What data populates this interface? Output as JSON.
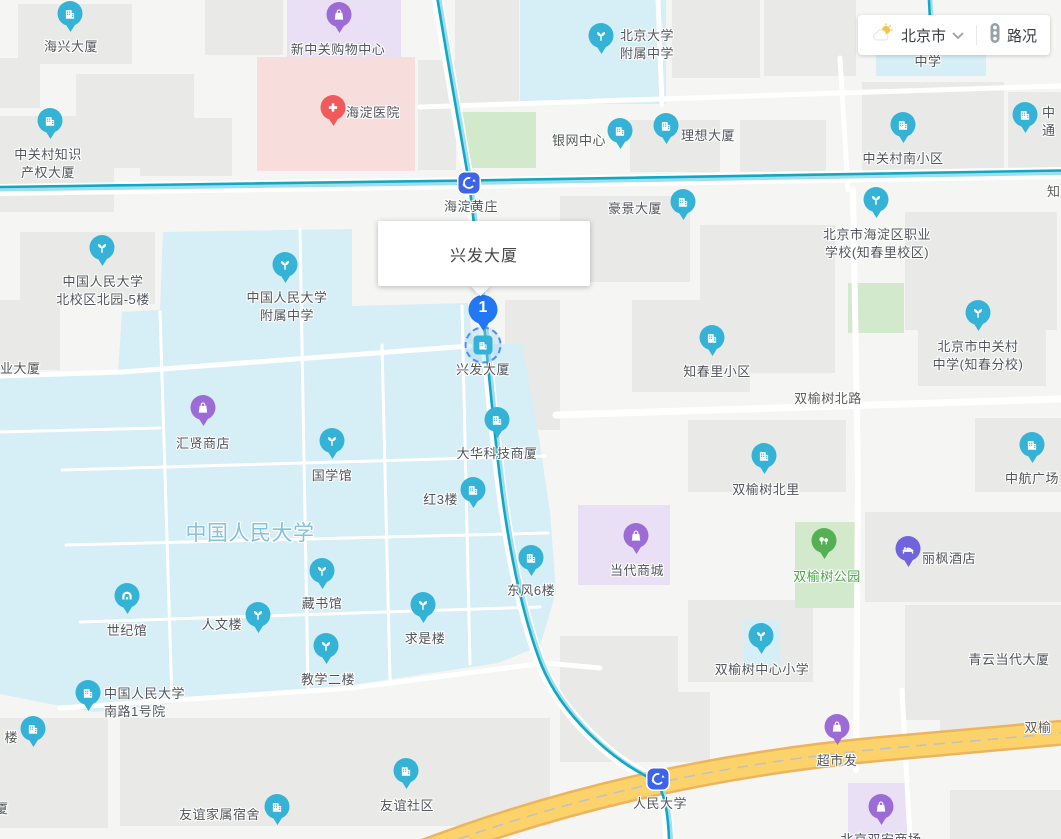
{
  "control": {
    "city": "北京市",
    "traffic_label": "路况"
  },
  "infowindow": {
    "title": "兴发大厦"
  },
  "selected_place": {
    "number": "1",
    "name": "兴发大厦"
  },
  "colors": {
    "pin_blue": "#35b3d7",
    "pin_purple": "#9c6bd6",
    "pin_violet": "#6f63de",
    "pin_green": "#55b054",
    "pin_red": "#ef5a5a",
    "selected_pin": "#2277f2",
    "station_blue": "#3d63ea",
    "subway_line": "#14a7c2",
    "highway_yellow": "#fbd36a",
    "campus_fill": "#d6eef5",
    "park_fill": "#d3e9cc",
    "hospital_fill": "#f8dddd",
    "mall_fill": "#e9e0f6"
  },
  "stations": [
    {
      "name": "海淀黄庄",
      "x": 469,
      "y": 183,
      "lx": 471,
      "ly": 198
    },
    {
      "name": "人民大学",
      "x": 658,
      "y": 779,
      "lx": 660,
      "ly": 795
    }
  ],
  "pois": [
    {
      "label": [
        "海兴大厦"
      ],
      "icon": "building",
      "color": "blue",
      "x": 70,
      "y": 34,
      "lx": 71,
      "ly": 38,
      "align": "center"
    },
    {
      "label": [
        "新中关购物中心"
      ],
      "icon": "bag",
      "color": "purple",
      "x": 339,
      "y": 35,
      "lx": 338,
      "ly": 41,
      "align": "center"
    },
    {
      "label": [
        "海淀医院"
      ],
      "icon": "cross",
      "color": "red",
      "x": 333,
      "y": 128,
      "lx": 346,
      "ly": 104,
      "align": "left"
    },
    {
      "label": [
        "中关村知识",
        "产权大厦"
      ],
      "icon": "building",
      "color": "blue",
      "x": 50,
      "y": 141,
      "lx": 48,
      "ly": 146,
      "align": "center"
    },
    {
      "label": [
        "北京大学",
        "附属中学"
      ],
      "icon": "sprout",
      "color": "blue",
      "x": 601,
      "y": 56,
      "lx": 620,
      "ly": 27,
      "align": "left"
    },
    {
      "label": [
        "银网中心"
      ],
      "icon": "building",
      "color": "blue",
      "x": 620,
      "y": 151,
      "lx": 606,
      "ly": 132,
      "align": "right"
    },
    {
      "label": [
        "理想大厦"
      ],
      "icon": "building",
      "color": "blue",
      "x": 666,
      "y": 146,
      "lx": 681,
      "ly": 127,
      "align": "left"
    },
    {
      "label": [
        "中关村南小区"
      ],
      "icon": "building",
      "color": "blue",
      "x": 903,
      "y": 145,
      "lx": 903,
      "ly": 150,
      "align": "center"
    },
    {
      "label": [
        "中",
        "通"
      ],
      "icon": "building",
      "color": "blue",
      "x": 1025,
      "y": 135,
      "lx": 1042,
      "ly": 104,
      "align": "left"
    },
    {
      "label": [
        "豪景大厦"
      ],
      "icon": "building",
      "color": "blue",
      "x": 683,
      "y": 222,
      "lx": 662,
      "ly": 200,
      "align": "right"
    },
    {
      "label": [
        "北京市海淀区职业",
        "学校(知春里校区)"
      ],
      "icon": "sprout",
      "color": "blue",
      "x": 876,
      "y": 220,
      "lx": 877,
      "ly": 226,
      "align": "center"
    },
    {
      "label": [
        "中国人民大学",
        "北校区北园-5楼"
      ],
      "icon": "sprout",
      "color": "blue",
      "x": 102,
      "y": 268,
      "lx": 103,
      "ly": 273,
      "align": "center"
    },
    {
      "label": [
        "中国人民大学",
        "附属中学"
      ],
      "icon": "sprout",
      "color": "blue",
      "x": 285,
      "y": 285,
      "lx": 287,
      "ly": 289,
      "align": "center"
    },
    {
      "label": [
        "知春里小区"
      ],
      "icon": "building",
      "color": "blue",
      "x": 712,
      "y": 358,
      "lx": 717,
      "ly": 363,
      "align": "center"
    },
    {
      "label": [
        "北京市中关村",
        "中学(知春分校)"
      ],
      "icon": "sprout",
      "color": "blue",
      "x": 978,
      "y": 333,
      "lx": 978,
      "ly": 338,
      "align": "center"
    },
    {
      "label": [
        "汇贤商店"
      ],
      "icon": "bag",
      "color": "purple",
      "x": 203,
      "y": 428,
      "lx": 203,
      "ly": 435,
      "align": "center"
    },
    {
      "label": [
        "大华科技商厦"
      ],
      "icon": "building",
      "color": "blue",
      "x": 497,
      "y": 440,
      "lx": 497,
      "ly": 445,
      "align": "center"
    },
    {
      "label": [
        "国学馆"
      ],
      "icon": "sprout",
      "color": "blue",
      "x": 332,
      "y": 461,
      "lx": 332,
      "ly": 467,
      "align": "center"
    },
    {
      "label": [
        "红3楼"
      ],
      "icon": "building",
      "color": "blue",
      "x": 473,
      "y": 510,
      "lx": 458,
      "ly": 491,
      "align": "right"
    },
    {
      "label": [
        "双榆树北里"
      ],
      "icon": "building",
      "color": "blue",
      "x": 764,
      "y": 476,
      "lx": 766,
      "ly": 481,
      "align": "center"
    },
    {
      "label": [
        "中航广场"
      ],
      "icon": "building",
      "color": "blue",
      "x": 1032,
      "y": 465,
      "lx": 1032,
      "ly": 470,
      "align": "center"
    },
    {
      "label": [
        "当代商城"
      ],
      "icon": "bag",
      "color": "purple",
      "x": 636,
      "y": 556,
      "lx": 637,
      "ly": 562,
      "align": "center"
    },
    {
      "label": [
        "双榆树公园"
      ],
      "icon": "trees",
      "color": "green",
      "x": 824,
      "y": 561,
      "lx": 827,
      "ly": 568,
      "align": "center",
      "text_color": "#48a649"
    },
    {
      "label": [
        "丽枫酒店"
      ],
      "icon": "bed",
      "color": "violet",
      "x": 908,
      "y": 569,
      "lx": 922,
      "ly": 550,
      "align": "left"
    },
    {
      "label": [
        "东风6楼"
      ],
      "icon": "building",
      "color": "blue",
      "x": 531,
      "y": 578,
      "lx": 531,
      "ly": 582,
      "align": "center"
    },
    {
      "label": [
        "藏书馆"
      ],
      "icon": "sprout",
      "color": "blue",
      "x": 322,
      "y": 591,
      "lx": 322,
      "ly": 595,
      "align": "center"
    },
    {
      "label": [
        "世纪馆"
      ],
      "icon": "stadium",
      "color": "blue",
      "x": 127,
      "y": 616,
      "lx": 127,
      "ly": 622,
      "align": "center"
    },
    {
      "label": [
        "人文楼"
      ],
      "icon": "sprout",
      "color": "blue",
      "x": 258,
      "y": 635,
      "lx": 242,
      "ly": 616,
      "align": "right"
    },
    {
      "label": [
        "求是楼"
      ],
      "icon": "sprout",
      "color": "blue",
      "x": 423,
      "y": 625,
      "lx": 425,
      "ly": 630,
      "align": "center"
    },
    {
      "label": [
        "教学二楼"
      ],
      "icon": "sprout",
      "color": "blue",
      "x": 326,
      "y": 666,
      "lx": 328,
      "ly": 671,
      "align": "center"
    },
    {
      "label": [
        "双榆树中心小学"
      ],
      "icon": "sprout",
      "color": "blue",
      "x": 761,
      "y": 656,
      "lx": 762,
      "ly": 661,
      "align": "center"
    },
    {
      "label": [
        "中国人民大学",
        "南路1号院"
      ],
      "icon": "building",
      "color": "blue",
      "x": 88,
      "y": 713,
      "lx": 104,
      "ly": 685,
      "align": "left"
    },
    {
      "label": [
        "楼"
      ],
      "icon": "building",
      "color": "blue",
      "x": 33,
      "y": 749,
      "lx": 18,
      "ly": 729,
      "align": "right"
    },
    {
      "label": [
        "超市发"
      ],
      "icon": "bag",
      "color": "purple",
      "x": 837,
      "y": 747,
      "lx": 837,
      "ly": 752,
      "align": "center"
    },
    {
      "label": [
        "友谊家属宿舍"
      ],
      "icon": "building",
      "color": "blue",
      "x": 277,
      "y": 827,
      "lx": 260,
      "ly": 806,
      "align": "right"
    },
    {
      "label": [
        "友谊社区"
      ],
      "icon": "building",
      "color": "blue",
      "x": 406,
      "y": 791,
      "lx": 407,
      "ly": 797,
      "align": "center"
    },
    {
      "label": [
        "北京双安商场"
      ],
      "icon": "bag",
      "color": "purple",
      "x": 881,
      "y": 827,
      "lx": 881,
      "ly": 831,
      "align": "center"
    }
  ],
  "plain_labels": [
    {
      "text": "中国人民大学",
      "x": 250,
      "y": 520,
      "align": "center",
      "size": 21,
      "color": "#85c1d7"
    },
    {
      "text": "双榆树北路",
      "x": 828,
      "y": 390,
      "align": "center",
      "size": 13,
      "color": "#5d5d5d"
    },
    {
      "text": "双榆",
      "x": 1038,
      "y": 719,
      "align": "center",
      "size": 13,
      "color": "#5d5d5d"
    },
    {
      "text": "知春",
      "x": 1047,
      "y": 183,
      "align": "left",
      "size": 13,
      "color": "#5d5d5d"
    },
    {
      "text": "青云当代大厦",
      "x": 1009,
      "y": 651,
      "align": "center",
      "size": 13,
      "color": "#51565d"
    },
    {
      "text": "业大厦",
      "x": 0,
      "y": 360,
      "align": "left",
      "size": 13,
      "color": "#51565d"
    },
    {
      "text": "中学",
      "x": 928,
      "y": 53,
      "align": "center",
      "size": 13,
      "color": "#51565d"
    },
    {
      "text": "厦",
      "x": -5,
      "y": 800,
      "align": "left",
      "size": 13,
      "color": "#51565d"
    }
  ]
}
